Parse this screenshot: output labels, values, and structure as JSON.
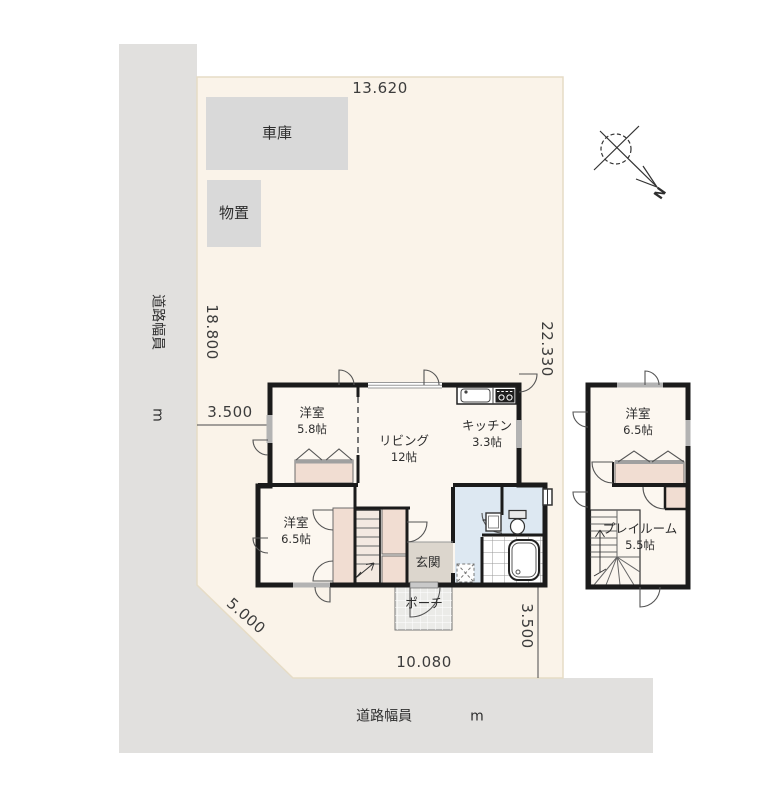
{
  "colors": {
    "lot": "#faf3e9",
    "road": "#e1e0de",
    "structure": "#d9d9d9",
    "wall": "#1b1b1b",
    "closet": "#f1ddd2",
    "water": "#dde8f2",
    "floor": "#fcf7f0",
    "genkan": "#dcd6cd",
    "porch": "#ebebe8"
  },
  "site": {
    "dims": {
      "top": "13.620",
      "left": "18.800",
      "left_offset": "3.500",
      "right": "22.330",
      "diagonal": "5.000",
      "bottom": "10.080",
      "bottom_offset": "3.500"
    },
    "road_left": {
      "label": "道路幅員",
      "unit": "m"
    },
    "road_bottom": {
      "label": "道路幅員",
      "unit": "m"
    },
    "garage": "車庫",
    "shed": "物置",
    "compass_n": "N"
  },
  "floor1": {
    "rooms": [
      {
        "name": "洋室",
        "size": "5.8帖"
      },
      {
        "name": "リビング",
        "size": "12帖"
      },
      {
        "name": "キッチン",
        "size": "3.3帖"
      },
      {
        "name": "洋室",
        "size": "6.5帖"
      },
      {
        "name": "玄関"
      },
      {
        "name": "ポーチ"
      }
    ]
  },
  "floor2": {
    "rooms": [
      {
        "name": "洋室",
        "size": "6.5帖"
      },
      {
        "name": "プレイルーム",
        "size": "5.5帖"
      }
    ]
  }
}
